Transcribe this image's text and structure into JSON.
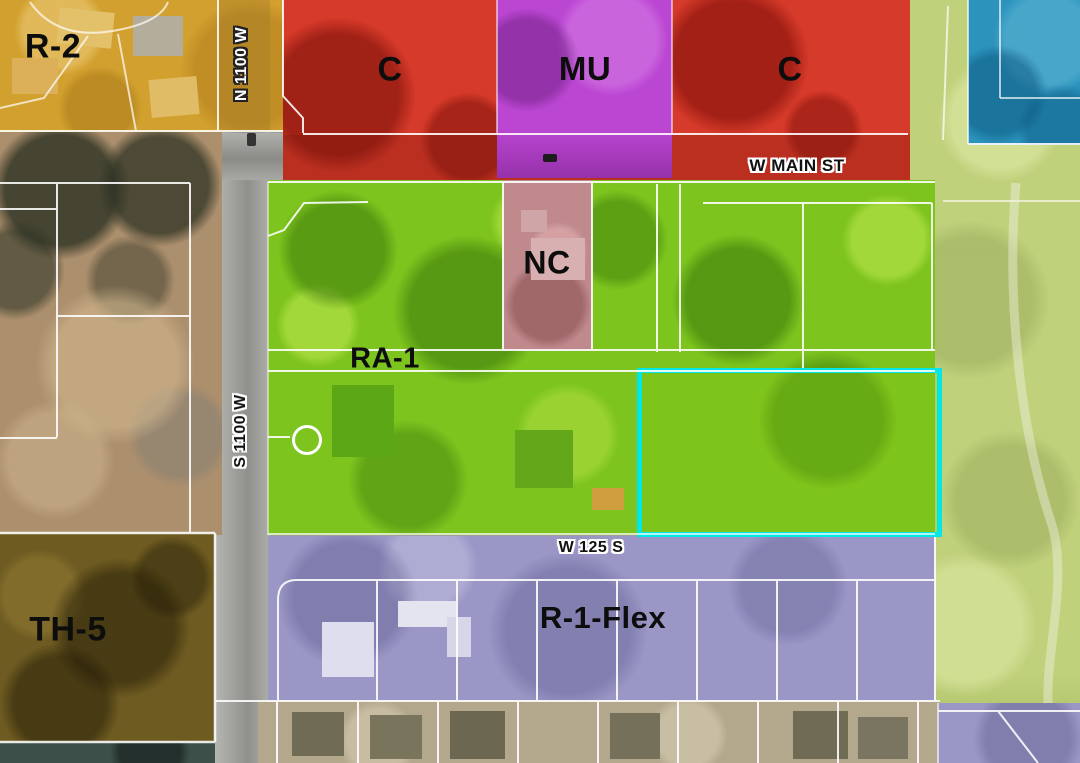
{
  "map_title": "Zoning map",
  "zones": {
    "r2": {
      "label": "R-2",
      "color": "#d2a02e"
    },
    "c_west": {
      "label": "C",
      "color": "#d63a2a"
    },
    "mu": {
      "label": "MU",
      "color": "#bb46d2"
    },
    "c_east": {
      "label": "C",
      "color": "#d63a2a"
    },
    "nc": {
      "label": "NC",
      "color": "#c08a8d"
    },
    "ra1": {
      "label": "RA-1",
      "color": "#7dc41e"
    },
    "th5": {
      "label": "TH-5",
      "color": "#6e5b21"
    },
    "r1flex": {
      "label": "R-1-Flex",
      "color": "#9a97c6"
    }
  },
  "unlabeled_zone_colors": {
    "blue_parcel": "#2b93bc",
    "light_green_area": "#c0d17c"
  },
  "streets": {
    "n1100w": {
      "label": "N 1100 W",
      "orientation": "vertical"
    },
    "s1100w": {
      "label": "S 1100 W",
      "orientation": "vertical"
    },
    "w_main": {
      "label": "W MAIN ST",
      "orientation": "horizontal"
    },
    "w125s": {
      "label": "W 125 S",
      "orientation": "horizontal"
    }
  },
  "selection": {
    "highlight_color": "#00e7e7",
    "within_zone": "RA-1"
  }
}
